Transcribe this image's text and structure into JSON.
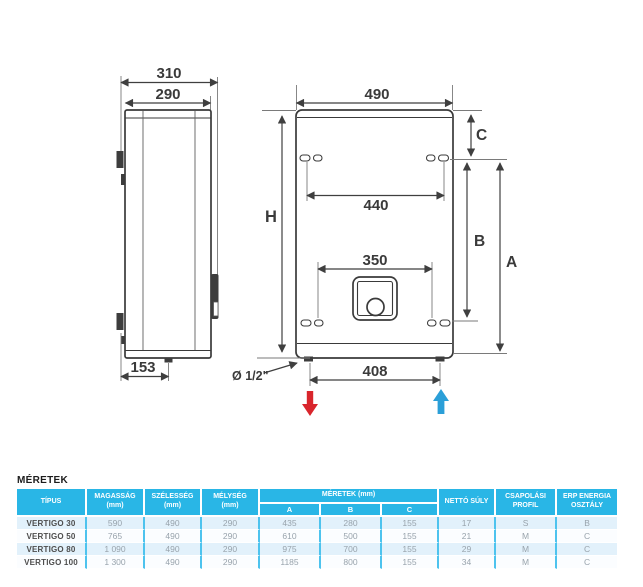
{
  "diagram": {
    "side_view": {
      "depth_overall": "310",
      "depth_body": "290",
      "bracket_offset": "153"
    },
    "front_view": {
      "width": "490",
      "mount_slot_span": "440",
      "panel_span": "350",
      "connection_span": "408",
      "height_label": "H",
      "dim_a_label": "A",
      "dim_b_label": "B",
      "dim_c_label": "C"
    },
    "connection_size": "Ø 1/2\"",
    "colors": {
      "outline": "#3a3a3a",
      "outlet_arrow_red": "#d9252c",
      "inlet_arrow_blue": "#2b9fd8"
    }
  },
  "table": {
    "title": "MÉRETEK",
    "accent": "#29b6e6",
    "headers": {
      "tipus": "TÍPUS",
      "magassag_label": "MAGASSÁG",
      "magassag_unit": "(mm)",
      "szelesseg_label": "SZÉLESSÉG",
      "szelesseg_unit": "(mm)",
      "melyseg_label": "MÉLYSÉG",
      "melyseg_unit": "(mm)",
      "meretek": "MÉRETEK (mm)",
      "a": "A",
      "b": "B",
      "c": "C",
      "netto_suly": "NETTÓ SÚLY",
      "csapolasi": "CSAPOLÁSI PROFIL",
      "erp": "ERP ENERGIA OSZTÁLY"
    },
    "rows": [
      {
        "tipus": "VERTIGO 30",
        "magassag": "590",
        "szelesseg": "490",
        "melyseg": "290",
        "a": "435",
        "b": "280",
        "c": "155",
        "netto_suly": "17",
        "csapolasi": "S",
        "erp": "B"
      },
      {
        "tipus": "VERTIGO 50",
        "magassag": "765",
        "szelesseg": "490",
        "melyseg": "290",
        "a": "610",
        "b": "500",
        "c": "155",
        "netto_suly": "21",
        "csapolasi": "M",
        "erp": "C"
      },
      {
        "tipus": "VERTIGO 80",
        "magassag": "1 090",
        "szelesseg": "490",
        "melyseg": "290",
        "a": "975",
        "b": "700",
        "c": "155",
        "netto_suly": "29",
        "csapolasi": "M",
        "erp": "C"
      },
      {
        "tipus": "VERTIGO 100",
        "magassag": "1 300",
        "szelesseg": "490",
        "melyseg": "290",
        "a": "1185",
        "b": "800",
        "c": "155",
        "netto_suly": "34",
        "csapolasi": "M",
        "erp": "C"
      }
    ]
  }
}
